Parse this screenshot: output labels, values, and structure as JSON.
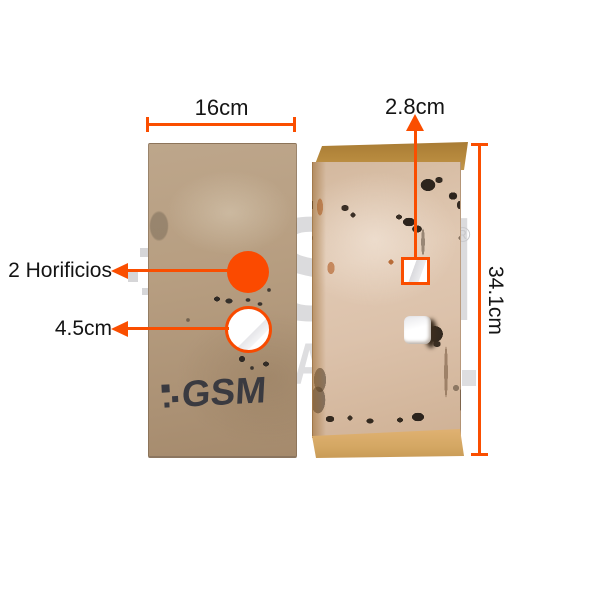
{
  "accent_color": "#FA4E00",
  "labels": {
    "width_dim": "16cm",
    "square_hole_dim": "2.8cm",
    "height_dim": "34.1cm",
    "holes_callout": "2 Horificios",
    "round_hole_dim": "4.5cm"
  },
  "left_plate": {
    "logo": "GSM",
    "stamp": "AT6091"
  },
  "watermark": {
    "brand": "GSM",
    "reg": "®",
    "letter": "A"
  }
}
